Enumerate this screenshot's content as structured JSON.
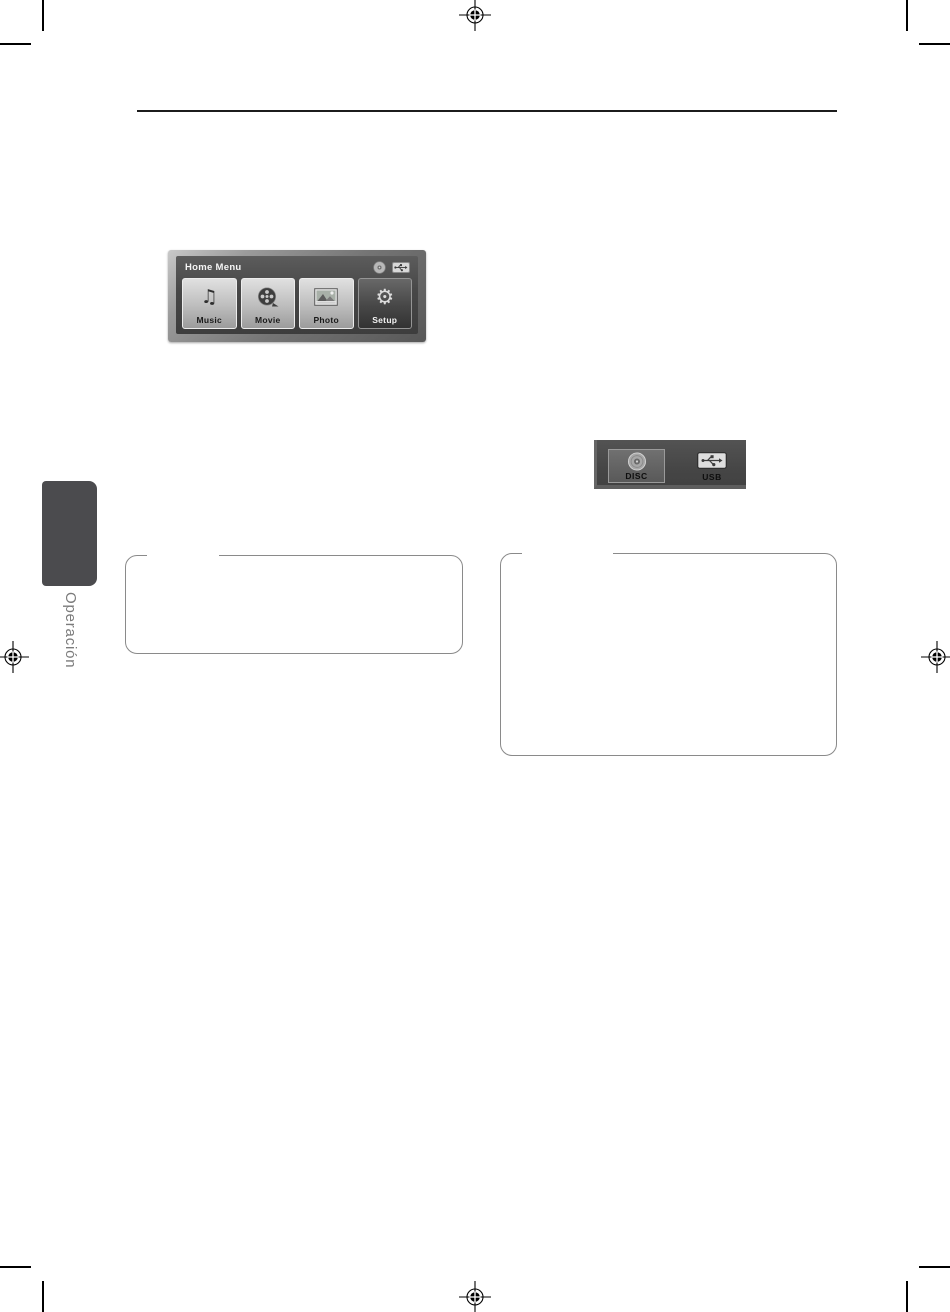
{
  "document": {
    "section_tab_label": "Operación"
  },
  "figures": {
    "home_menu": {
      "title": "Home Menu",
      "status_icons": [
        "disc-icon",
        "usb-icon"
      ],
      "tiles": [
        {
          "label": "Music",
          "icon": "music-note-icon",
          "selected": false
        },
        {
          "label": "Movie",
          "icon": "film-reel-icon",
          "selected": false
        },
        {
          "label": "Photo",
          "icon": "photo-icon",
          "selected": false
        },
        {
          "label": "Setup",
          "icon": "gear-icon",
          "selected": true
        }
      ]
    },
    "device_select": {
      "items": [
        {
          "label": "DISC",
          "icon": "disc-icon",
          "selected": true
        },
        {
          "label": "USB",
          "icon": "usb-icon",
          "selected": false
        }
      ]
    }
  },
  "colors": {
    "tab_background": "#4b4b4e",
    "tab_text": "#7b7b7b",
    "note_box_border": "#8a8a8a",
    "header_rule": "#1c1c1c",
    "screen_dark": "#474747"
  }
}
